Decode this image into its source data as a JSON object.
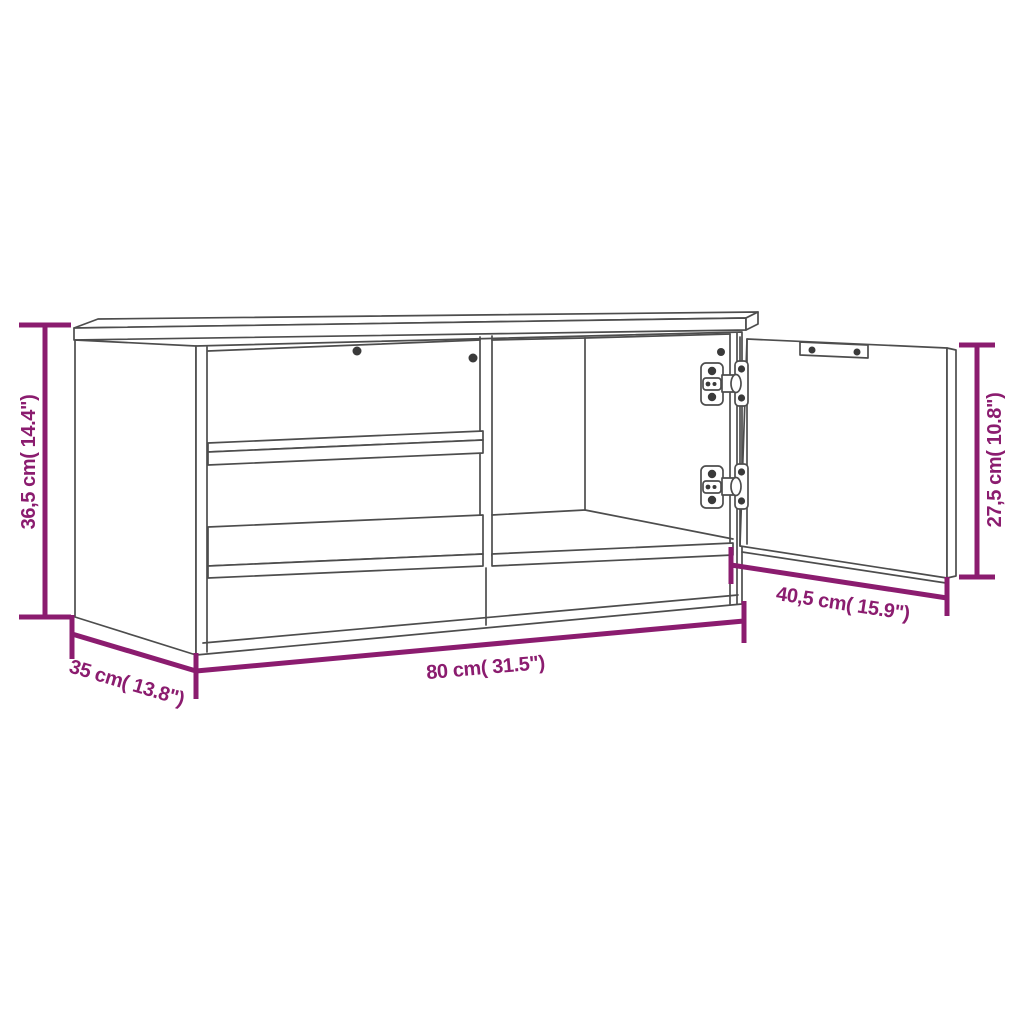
{
  "colors": {
    "accent": "#8B1C6F",
    "line_art": "#4D4D4D",
    "hardware": "#3A3A3A",
    "background": "#FFFFFF"
  },
  "dims": {
    "height": {
      "value_cm": "36,5",
      "value_in": "14.4",
      "label": "36,5 cm( 14.4\")"
    },
    "depth": {
      "value_cm": "35",
      "value_in": "13.8",
      "label": "35 cm( 13.8\")"
    },
    "width": {
      "value_cm": "80",
      "value_in": "31.5",
      "label": "80 cm( 31.5\")"
    },
    "door_width": {
      "value_cm": "40,5",
      "value_in": "15.9",
      "label": "40,5 cm( 15.9\")"
    },
    "door_height": {
      "value_cm": "27,5",
      "value_in": "10.8",
      "label": "27,5 cm( 10.8\")"
    }
  }
}
